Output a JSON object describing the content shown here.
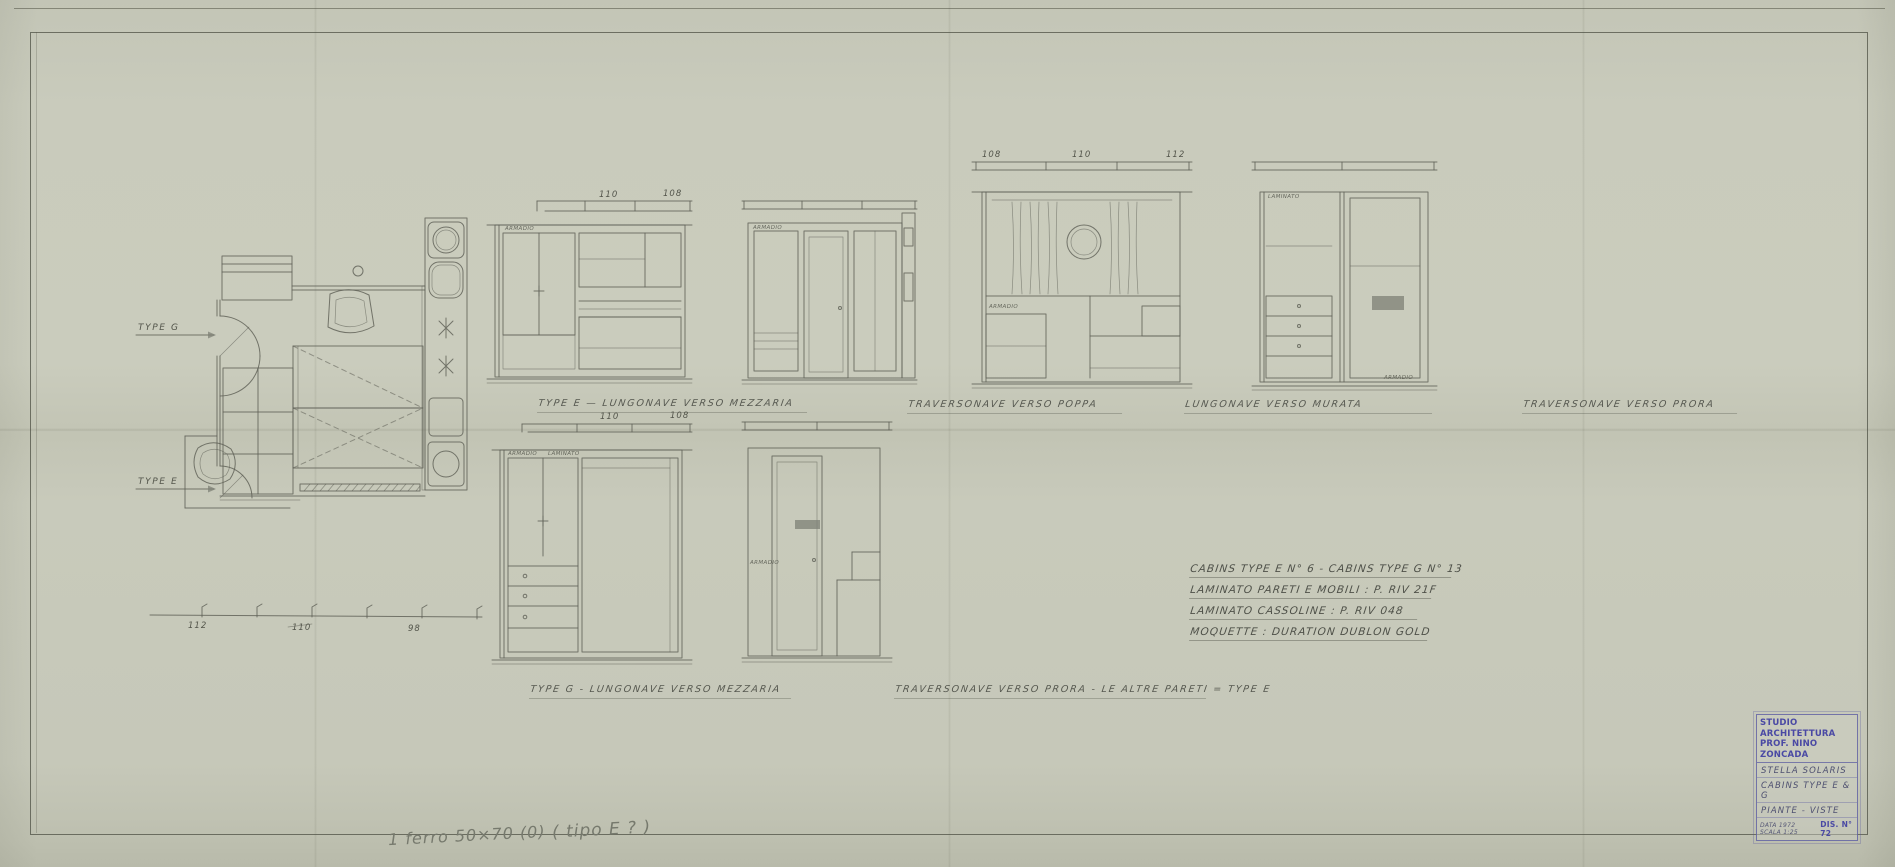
{
  "sheet": {
    "plan": {
      "label_type_g": "TYPE G",
      "label_type_e": "TYPE E",
      "dims": [
        "112",
        "110",
        "98"
      ]
    },
    "elevations": [
      {
        "caption": "TYPE E  —  LUNGONAVE VERSO MEZZARIA",
        "dims": [
          "110",
          "108"
        ],
        "inner_labels": [
          "ARMADIO"
        ]
      },
      {
        "caption": "TRAVERSONAVE VERSO POPPA",
        "inner_labels": [
          "ARMADIO"
        ]
      },
      {
        "caption": "LUNGONAVE VERSO MURATA",
        "dims": [
          "108",
          "110",
          "112"
        ],
        "inner_labels": [
          "ARMADIO"
        ]
      },
      {
        "caption": "TRAVERSONAVE VERSO PRORA",
        "inner_labels": [
          "LAMINATO",
          "ARMADIO"
        ]
      },
      {
        "caption": "TYPE G -  LUNGONAVE VERSO MEZZARIA",
        "dims": [
          "110",
          "108"
        ],
        "inner_labels": [
          "ARMADIO",
          "LAMINATO"
        ]
      },
      {
        "caption": "TRAVERSONAVE VERSO PRORA  -  LE ALTRE PARETI = TYPE E",
        "inner_labels": [
          "ARMADIO"
        ]
      }
    ],
    "notes": [
      "CABINS TYPE E  N° 6  -  CABINS TYPE G  N° 13",
      "LAMINATO PARETI E MOBILI :  P. RIV 21F",
      "LAMINATO CASSOLINE :  P. RIV 048",
      "MOQUETTE :  DURATION DUBLON GOLD"
    ],
    "stamp": {
      "studio1": "STUDIO ARCHITETTURA",
      "studio2": "PROF. NINO ZONCADA",
      "project": "STELLA SOLARIS",
      "subject": "CABINS TYPE E & G",
      "content": "PIANTE - VISTE",
      "meta_left": "DATA 1972  SCALA 1:25",
      "meta_right": "DIS. N° 72"
    },
    "pencil_notes": {
      "left": "1 ferro 50×70 (0)",
      "right": "( tipo E ? )"
    }
  }
}
